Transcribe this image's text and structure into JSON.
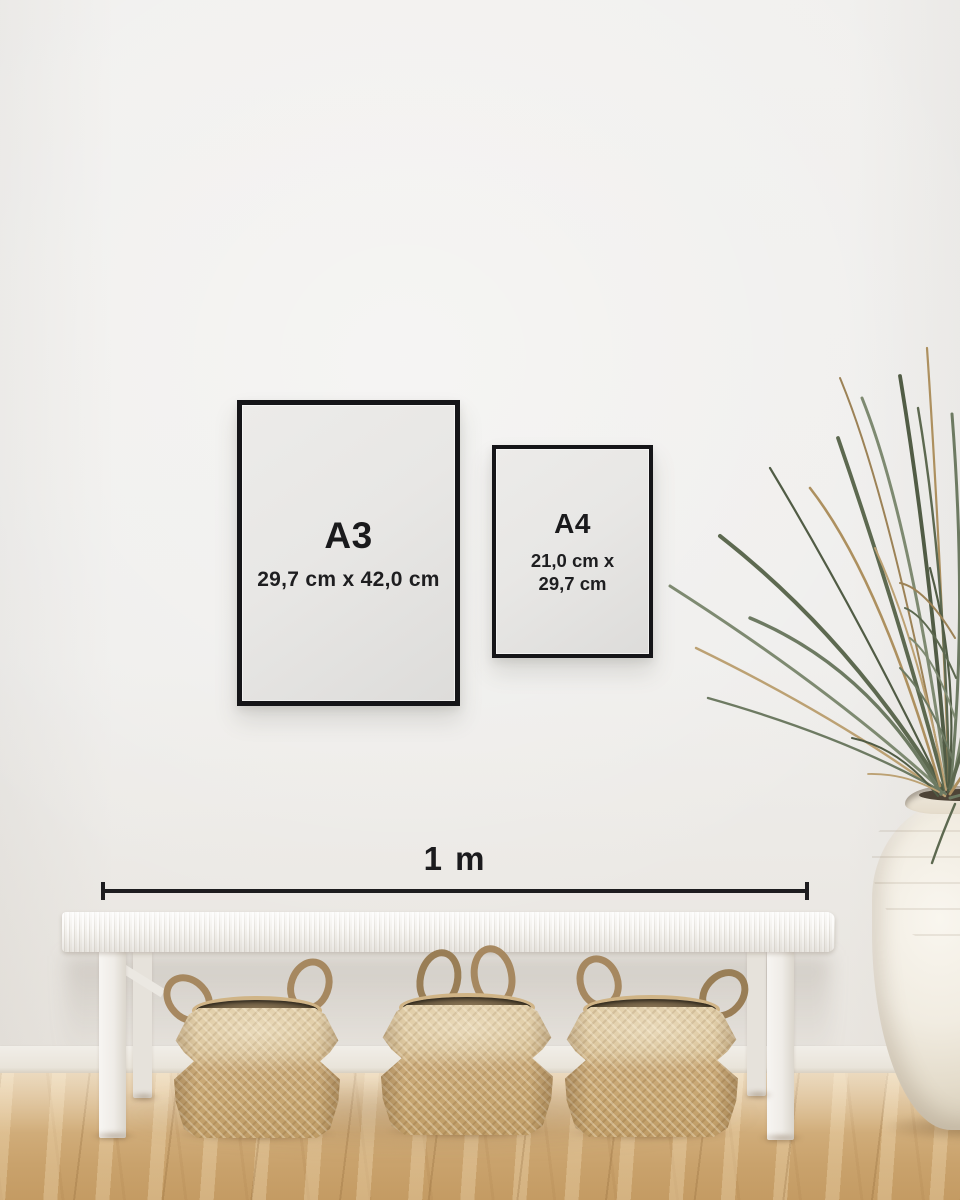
{
  "frames": {
    "a3": {
      "label": "A3",
      "dimensions": "29,7 cm x 42,0 cm"
    },
    "a4": {
      "label": "A4",
      "dimensions_line1": "21,0 cm x",
      "dimensions_line2": "29,7 cm"
    }
  },
  "scale_bar": {
    "label": "1 m"
  },
  "palette": {
    "wall": "#efeeec",
    "frame_border": "#151518",
    "text": "#1b1b1d",
    "floor_oak": "#d0ab77",
    "basket_tan": "#cbab7a",
    "basket_rim": "#6e5d43",
    "bench_white": "#f4f2ee",
    "vase_cream": "#f1ece1",
    "plant_green": "#5d6950",
    "plant_dried": "#ad905f"
  }
}
